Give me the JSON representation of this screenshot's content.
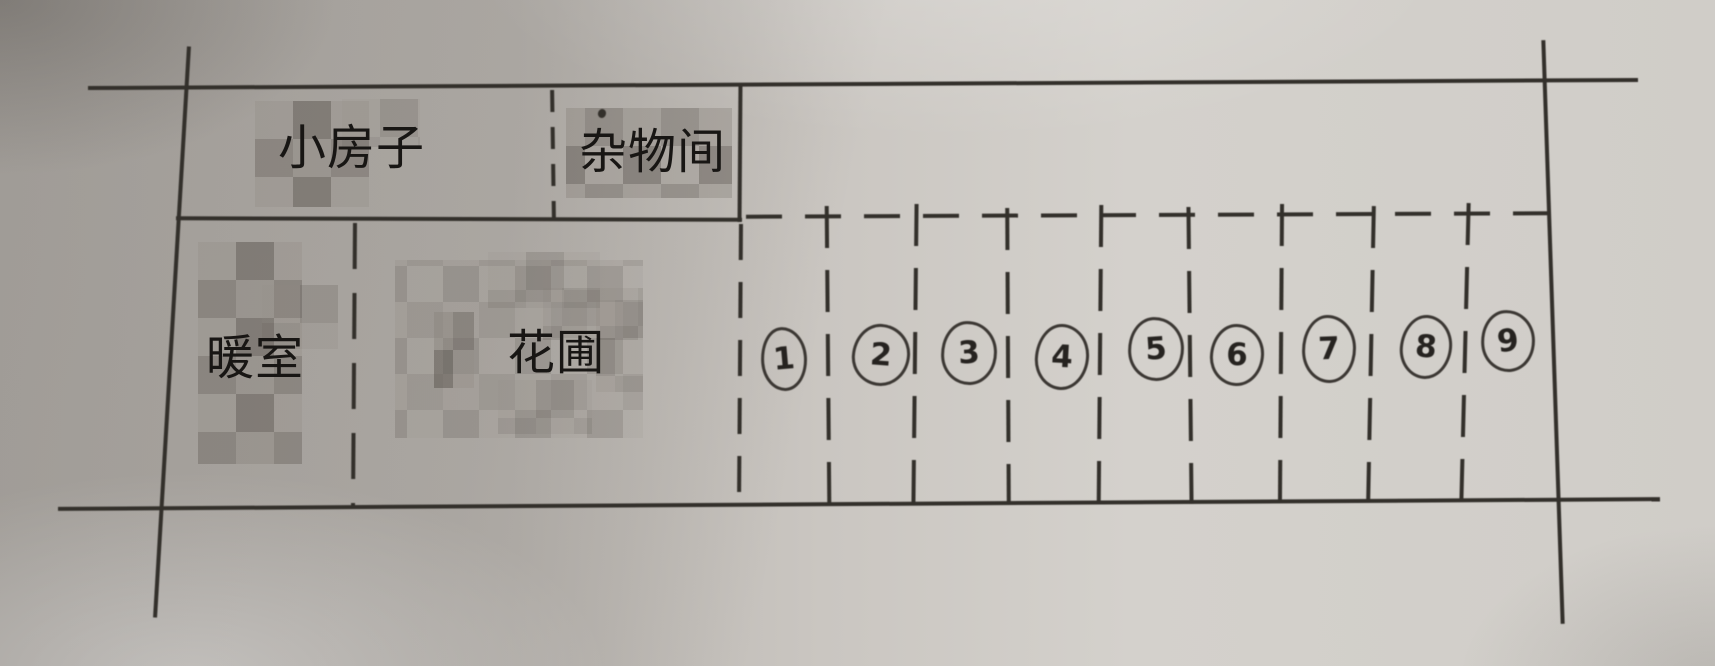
{
  "plan": {
    "top_row": {
      "small_house_label": "小房子",
      "storage_room_label": "杂物间"
    },
    "bottom_row": {
      "warm_room_label": "暖室",
      "flower_bed_label": "花圃"
    },
    "plots": [
      {
        "number": "1"
      },
      {
        "number": "2"
      },
      {
        "number": "3"
      },
      {
        "number": "4"
      },
      {
        "number": "5"
      },
      {
        "number": "6"
      },
      {
        "number": "7"
      },
      {
        "number": "8"
      },
      {
        "number": "9"
      }
    ]
  },
  "colors": {
    "paper_base": "#c9c5c0",
    "ink": "#33302b",
    "mosaic_dark": "#6f6a64",
    "mosaic_light": "#8d8882"
  }
}
